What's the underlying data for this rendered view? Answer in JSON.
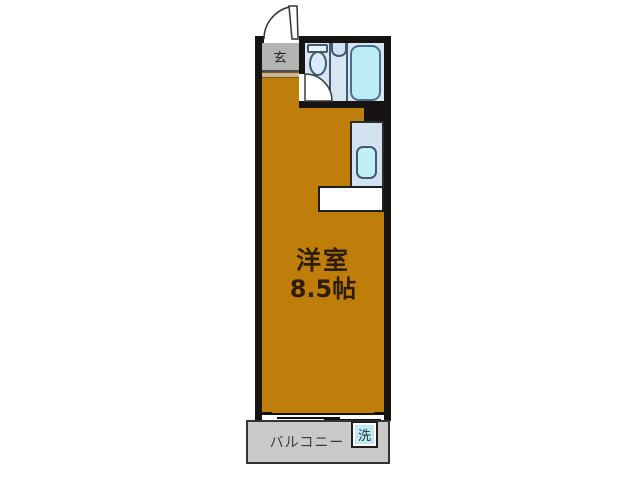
{
  "floorplan": {
    "entrance_label": "玄",
    "main_room": {
      "name": "洋室",
      "size": "8.5帖"
    },
    "balcony_label": "バルコニー",
    "washer_label": "洗",
    "colors": {
      "room_fill": "#BF7E09",
      "bathroom_fill": "#D7E6F2",
      "bathtub_fill": "#BCEDF5",
      "kitchen_fill": "#D2E2F0",
      "kitchen_sink_fill": "#C2EFF6",
      "entrance_fill": "#B3B3B3",
      "balcony_fill": "#C9C9C9",
      "washer_fill": "#C2E9F2",
      "wall": "#161412",
      "background": "#FFFFFF"
    }
  }
}
